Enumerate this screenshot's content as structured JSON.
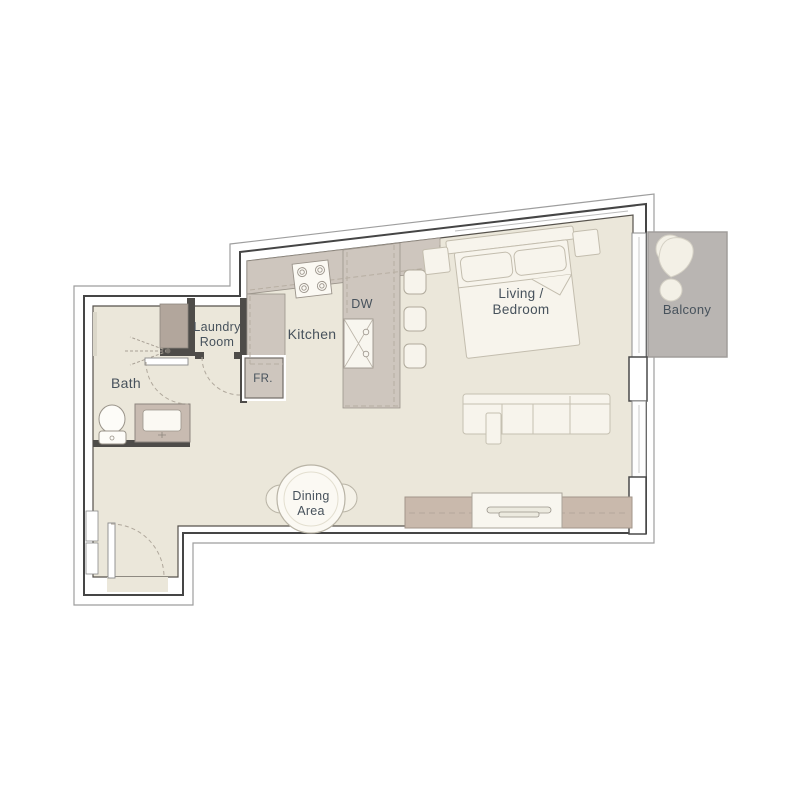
{
  "title": "Studio apartment floor plan",
  "colors": {
    "background": "#FFFFFF",
    "floor": "#EBE7DA",
    "counter": "#CEC6BE",
    "console": "#C9B9AC",
    "balcony": "#B9B5B2",
    "shower_block": "#B2A69C",
    "vanity": "#C8BBB1",
    "wall_line": "#4A4A4A",
    "furniture": "#F7F4EC",
    "text": "#47525C"
  },
  "rooms": {
    "bath": {
      "label": "Bath"
    },
    "laundry": {
      "line1": "Laundry",
      "line2": "Room"
    },
    "kitchen": {
      "label": "Kitchen"
    },
    "living": {
      "line1": "Living /",
      "line2": "Bedroom"
    },
    "dining": {
      "line1": "Dining",
      "line2": "Area"
    },
    "balcony": {
      "label": "Balcony"
    }
  },
  "appliances": {
    "fridge": "FR.",
    "dishwasher": "DW"
  }
}
